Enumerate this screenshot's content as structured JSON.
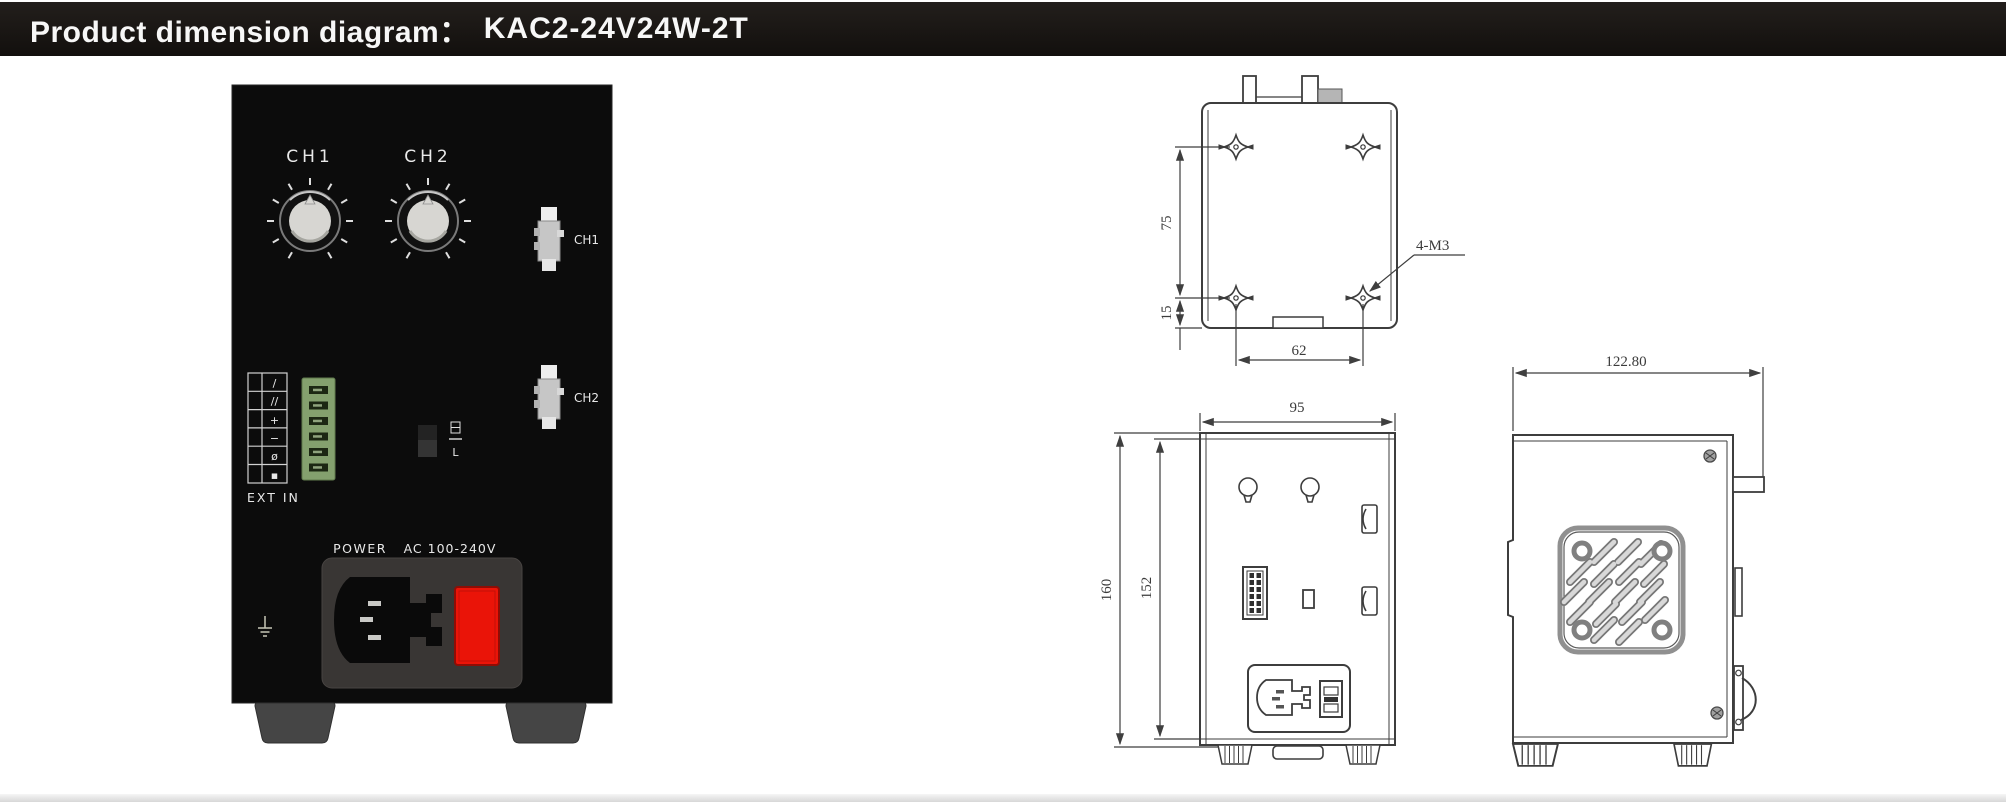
{
  "header": {
    "title": "Product dimension diagram：",
    "model": "KAC2-24V24W-2T"
  },
  "photo": {
    "knob1_label": "CH1",
    "knob2_label": "CH2",
    "connector1_label": "CH1",
    "connector2_label": "CH2",
    "terminal_table_symbols": [
      "/",
      "//",
      "+",
      "−",
      "ø",
      "▪"
    ],
    "terminal_caption": "EXT IN",
    "switch_mark": "L",
    "power_label": "POWER",
    "voltage_label": "AC 100-240V"
  },
  "drawings": {
    "top_view": {
      "hole_spacing_vertical": "75",
      "hole_bottom_offset": "15",
      "hole_spacing_horizontal": "62",
      "screw_note": "4-M3"
    },
    "front_view": {
      "width": "95",
      "height_outer": "160",
      "height_inner": "152"
    },
    "side_view": {
      "depth": "122.80"
    }
  },
  "colors": {
    "accent_red": "#ea1408",
    "terminal_green": "#84a06e",
    "titlebar_bg": "#17130f"
  }
}
